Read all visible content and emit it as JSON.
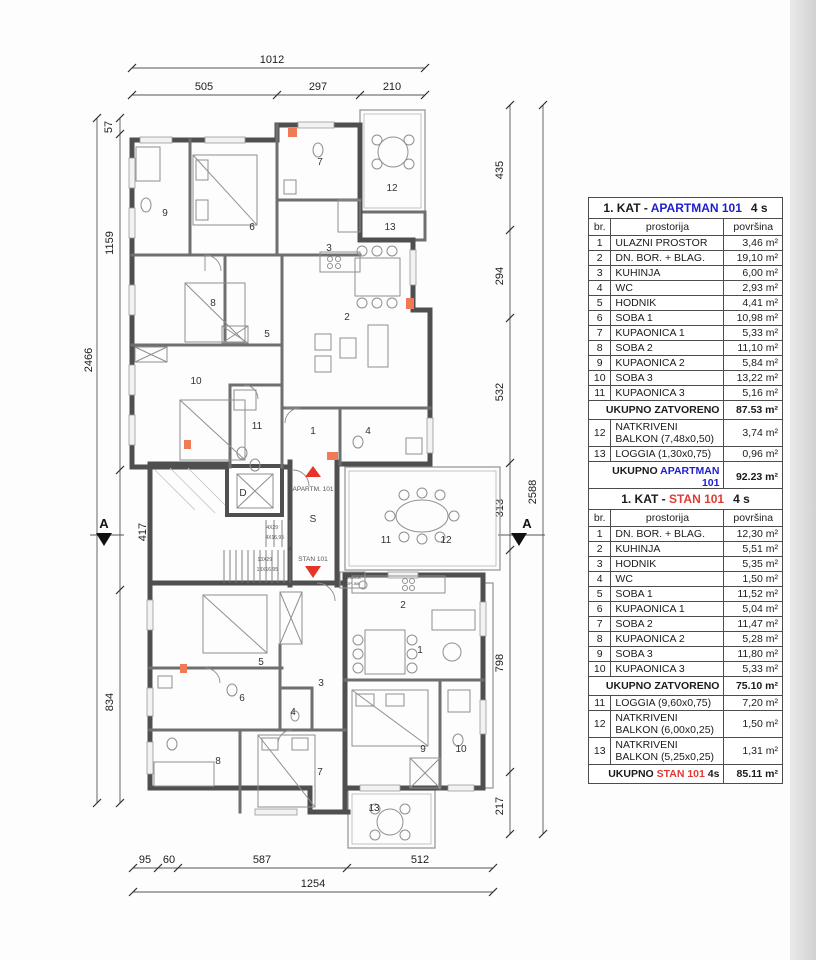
{
  "plan": {
    "dims_top": [
      "1012",
      "505",
      "297",
      "210"
    ],
    "dims_left": [
      "57",
      "1159",
      "417",
      "834"
    ],
    "dims_left_total": "2466",
    "dims_right": [
      "435",
      "294",
      "532",
      "313",
      "798",
      "217"
    ],
    "dims_right_total": "2588",
    "dims_bottom": [
      "95",
      "60",
      "587",
      "512"
    ],
    "dims_bottom_total": "1254",
    "section_label": "A",
    "core": {
      "elevator": "D",
      "stair_hall": "S",
      "up_label": "APARTM. 101",
      "down_label": "STAN 101",
      "stairs_up_treads": "4X29",
      "stairs_up_risers": "4X16,95",
      "stairs_down_treads": "13X29",
      "stairs_down_risers": "13X16,95",
      "heat_pump_line1": "DIZALICA",
      "heat_pump_line2": "TOPLINE"
    },
    "upper_rooms": [
      "1",
      "2",
      "3",
      "4",
      "5",
      "6",
      "7",
      "8",
      "9",
      "10",
      "11",
      "12",
      "13"
    ],
    "lower_rooms": [
      "1",
      "2",
      "3",
      "4",
      "5",
      "6",
      "7",
      "8",
      "9",
      "10",
      "11",
      "12",
      "13"
    ],
    "mid_rooms": [
      "11",
      "12"
    ]
  },
  "tables": {
    "apartman": {
      "title_prefix": "1. KAT - ",
      "title_name": "APARTMAN 101",
      "title_suffix": "4 s",
      "col_br": "br.",
      "col_room": "prostorija",
      "col_area": "površina",
      "rows": [
        {
          "br": "1",
          "name": "ULAZNI PROSTOR",
          "area": "3,46 m²"
        },
        {
          "br": "2",
          "name": "DN. BOR. + BLAG.",
          "area": "19,10 m²"
        },
        {
          "br": "3",
          "name": "KUHINJA",
          "area": "6,00 m²"
        },
        {
          "br": "4",
          "name": "WC",
          "area": "2,93 m²"
        },
        {
          "br": "5",
          "name": "HODNIK",
          "area": "4,41 m²"
        },
        {
          "br": "6",
          "name": "SOBA 1",
          "area": "10,98 m²"
        },
        {
          "br": "7",
          "name": "KUPAONICA 1",
          "area": "5,33 m²"
        },
        {
          "br": "8",
          "name": "SOBA 2",
          "area": "11,10 m²"
        },
        {
          "br": "9",
          "name": "KUPAONICA 2",
          "area": "5,84 m²"
        },
        {
          "br": "10",
          "name": "SOBA 3",
          "area": "13,22 m²"
        },
        {
          "br": "11",
          "name": "KUPAONICA 3",
          "area": "5,16 m²"
        }
      ],
      "subtotal_label": "UKUPNO ZATVORENO",
      "subtotal_value": "87.53 m²",
      "extra_rows": [
        {
          "br": "12",
          "name": "NATKRIVENI BALKON (7,48x0,50)",
          "area": "3,74 m²"
        },
        {
          "br": "13",
          "name": "LOGGIA (1,30x0,75)",
          "area": "0,96 m²"
        }
      ],
      "total_prefix": "UKUPNO ",
      "total_name": "APARTMAN 101",
      "total_suffix": "",
      "total_value": "92.23 m²"
    },
    "stan": {
      "title_prefix": "1. KAT - ",
      "title_name": "STAN 101",
      "title_suffix": "4 s",
      "col_br": "br.",
      "col_room": "prostorija",
      "col_area": "površina",
      "rows": [
        {
          "br": "1",
          "name": "DN. BOR. + BLAG.",
          "area": "12,30 m²"
        },
        {
          "br": "2",
          "name": "KUHINJA",
          "area": "5,51 m²"
        },
        {
          "br": "3",
          "name": "HODNIK",
          "area": "5,35 m²"
        },
        {
          "br": "4",
          "name": "WC",
          "area": "1,50 m²"
        },
        {
          "br": "5",
          "name": "SOBA 1",
          "area": "11,52 m²"
        },
        {
          "br": "6",
          "name": "KUPAONICA 1",
          "area": "5,04 m²"
        },
        {
          "br": "7",
          "name": "SOBA 2",
          "area": "11,47 m²"
        },
        {
          "br": "8",
          "name": "KUPAONICA 2",
          "area": "5,28 m²"
        },
        {
          "br": "9",
          "name": "SOBA 3",
          "area": "11,80 m²"
        },
        {
          "br": "10",
          "name": "KUPAONICA 3",
          "area": "5,33 m²"
        }
      ],
      "subtotal_label": "UKUPNO ZATVORENO",
      "subtotal_value": "75.10 m²",
      "extra_rows": [
        {
          "br": "11",
          "name": "LOGGIA (9,60x0,75)",
          "area": "7,20 m²"
        },
        {
          "br": "12",
          "name": "NATKRIVENI BALKON (6,00x0,25)",
          "area": "1,50 m²"
        },
        {
          "br": "13",
          "name": "NATKRIVENI BALKON (5,25x0,25)",
          "area": "1,31 m²"
        }
      ],
      "total_prefix": "UKUPNO ",
      "total_name": "STAN 101",
      "total_suffix": "4s",
      "total_value": "85.11 m²"
    }
  }
}
